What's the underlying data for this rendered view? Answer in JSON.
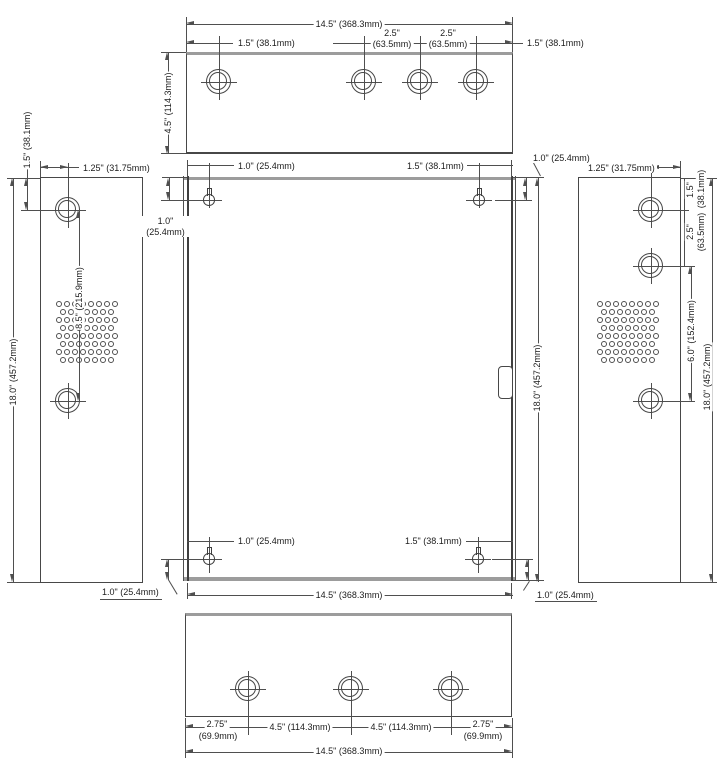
{
  "colors": {
    "line": "#4f4f4f",
    "face_edge": "#9c9c9c",
    "text": "#1c1c1c",
    "background": "#ffffff"
  },
  "views": {
    "top": {
      "overall_width": "14.5\" (368.3mm)",
      "left_hole": "1.5\" (38.1mm)",
      "spacing1_in": "2.5\"",
      "spacing1_mm": "(63.5mm)",
      "spacing2_in": "2.5\"",
      "spacing2_mm": "(63.5mm)",
      "right_hole": "1.5\" (38.1mm)",
      "depth": "4.5\" (114.3mm)"
    },
    "front": {
      "slot_top_left_x": "1.0\" (25.4mm)",
      "slot_top_right_x": "1.5\" (38.1mm)",
      "slot_top_left_y_in": "1.0\"",
      "slot_top_left_y_mm": "(25.4mm)",
      "slot_top_right_y": "1.0\" (25.4mm)",
      "height": "18.0\" (457.2mm)",
      "slot_bottom_left_x": "1.0\" (25.4mm)",
      "slot_bottom_right_x": "1.5\" (38.1mm)",
      "overall_width": "14.5\" (368.3mm)",
      "slot_bottom_left_y": "1.0\" (25.4mm)",
      "slot_bottom_right_y": "1.0\" (25.4mm)"
    },
    "left": {
      "hole_offset": "1.25\" (31.75mm)",
      "top_hole": "1.5\" (38.1mm)",
      "hole_spacing": "8.5\" (215.9mm)",
      "height": "18.0\" (457.2mm)"
    },
    "right": {
      "hole_offset": "1.25\" (31.75mm)",
      "top_hole_in": "1.5\"",
      "top_hole_mm": "(38.1mm)",
      "spacing_in": "2.5\"",
      "spacing_mm": "(63.5mm)",
      "lower_spacing": "6.0\" (152.4mm)",
      "height": "18.0\" (457.2mm)"
    },
    "bottom": {
      "left_in": "2.75\"",
      "left_mm": "(69.9mm)",
      "span1": "4.5\" (114.3mm)",
      "span2": "4.5\" (114.3mm)",
      "right_in": "2.75\"",
      "right_mm": "(69.9mm)",
      "overall_width": "14.5\" (368.3mm)"
    }
  }
}
